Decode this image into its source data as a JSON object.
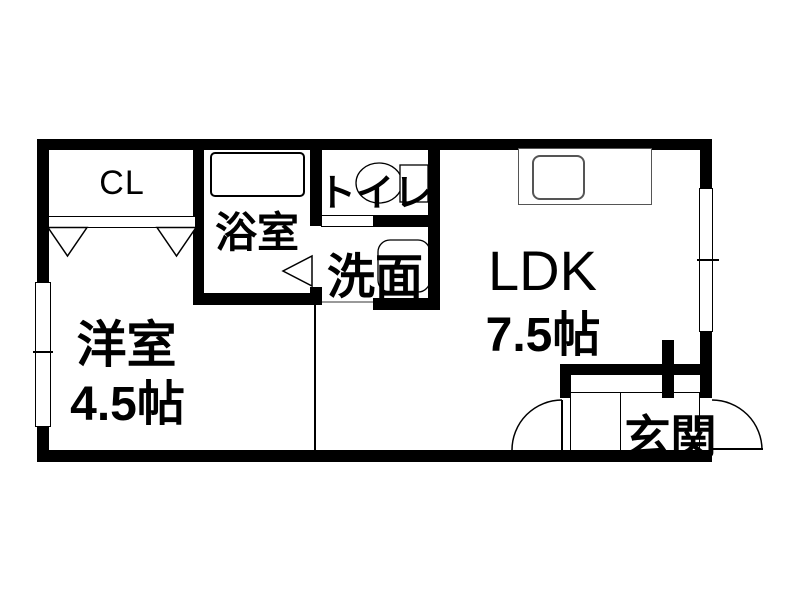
{
  "plan": {
    "type": "apartment-floor-plan",
    "colors": {
      "wall": "#000000",
      "background": "#ffffff",
      "fixture_outline": "#555555",
      "threshold_line": "#999999"
    },
    "rooms": {
      "closet": {
        "label": "CL"
      },
      "bathroom": {
        "label": "浴室"
      },
      "toilet": {
        "label": "トイレ"
      },
      "washroom": {
        "label": "洗面"
      },
      "ldk": {
        "label": "LDK",
        "size": "7.5帖"
      },
      "western_room": {
        "label": "洋室",
        "size": "4.5帖"
      },
      "entrance": {
        "label": "玄関"
      }
    }
  }
}
